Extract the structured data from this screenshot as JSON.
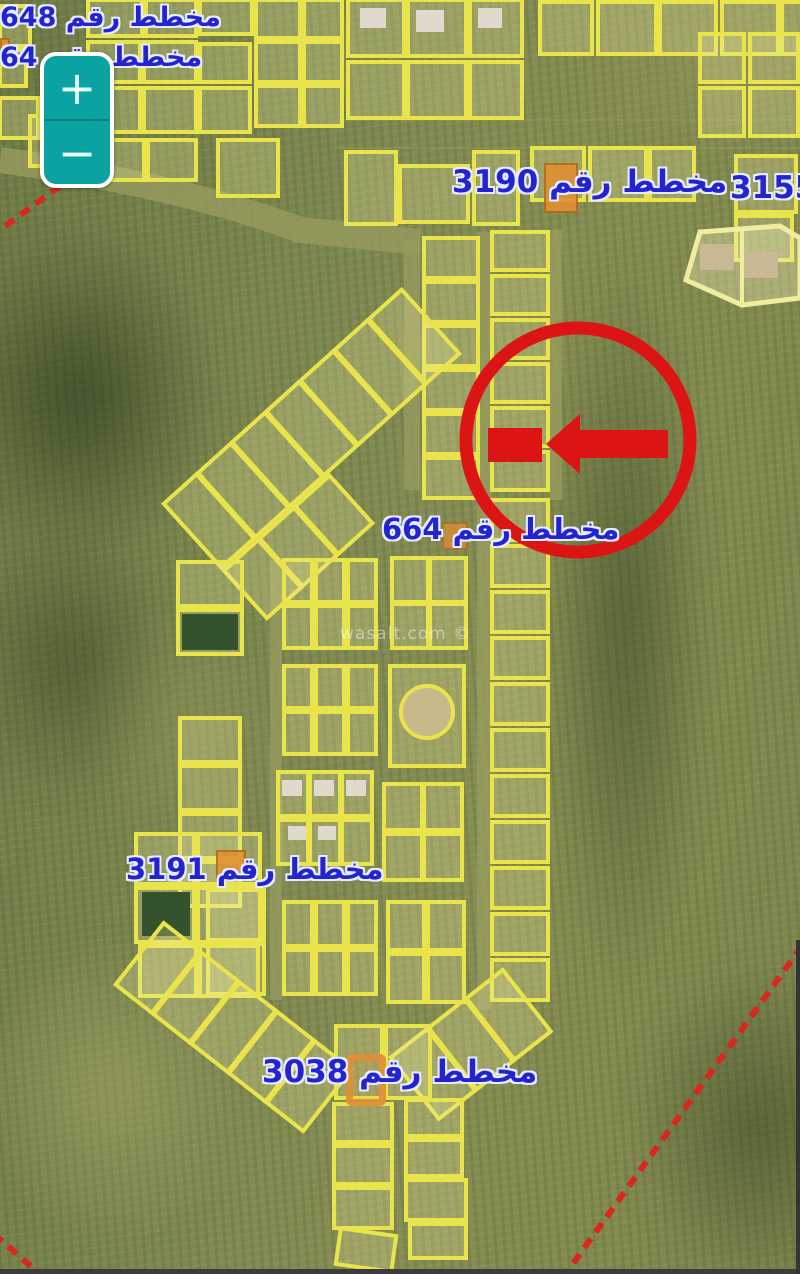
{
  "controls": {
    "zoom_in_label": "+",
    "zoom_out_label": "−"
  },
  "map": {
    "watermark": "wasalt.com ©",
    "plan_labels": {
      "plan_648": "مخطط رقم 648",
      "plan_64": "مخطط رقم 64",
      "plan_3190": "مخطط رقم 3190",
      "plan_3155": "3155",
      "plan_664": "مخطط رقم 664",
      "plan_3191": "مخطط رقم 3191",
      "plan_3038": "مخطط رقم 3038"
    }
  },
  "colors": {
    "parcel_outline": "#e9e44c",
    "parcel_fill": "rgba(240,235,160,0.26)",
    "label_blue": "#2323cf",
    "annotation_red": "#dd1414",
    "boundary_red": "#d8281e",
    "marker_orange": "#e09035",
    "zoom_teal": "#0ba2a2",
    "terrain_base": "#7d8850",
    "letterbox": "#3c3c3c"
  }
}
